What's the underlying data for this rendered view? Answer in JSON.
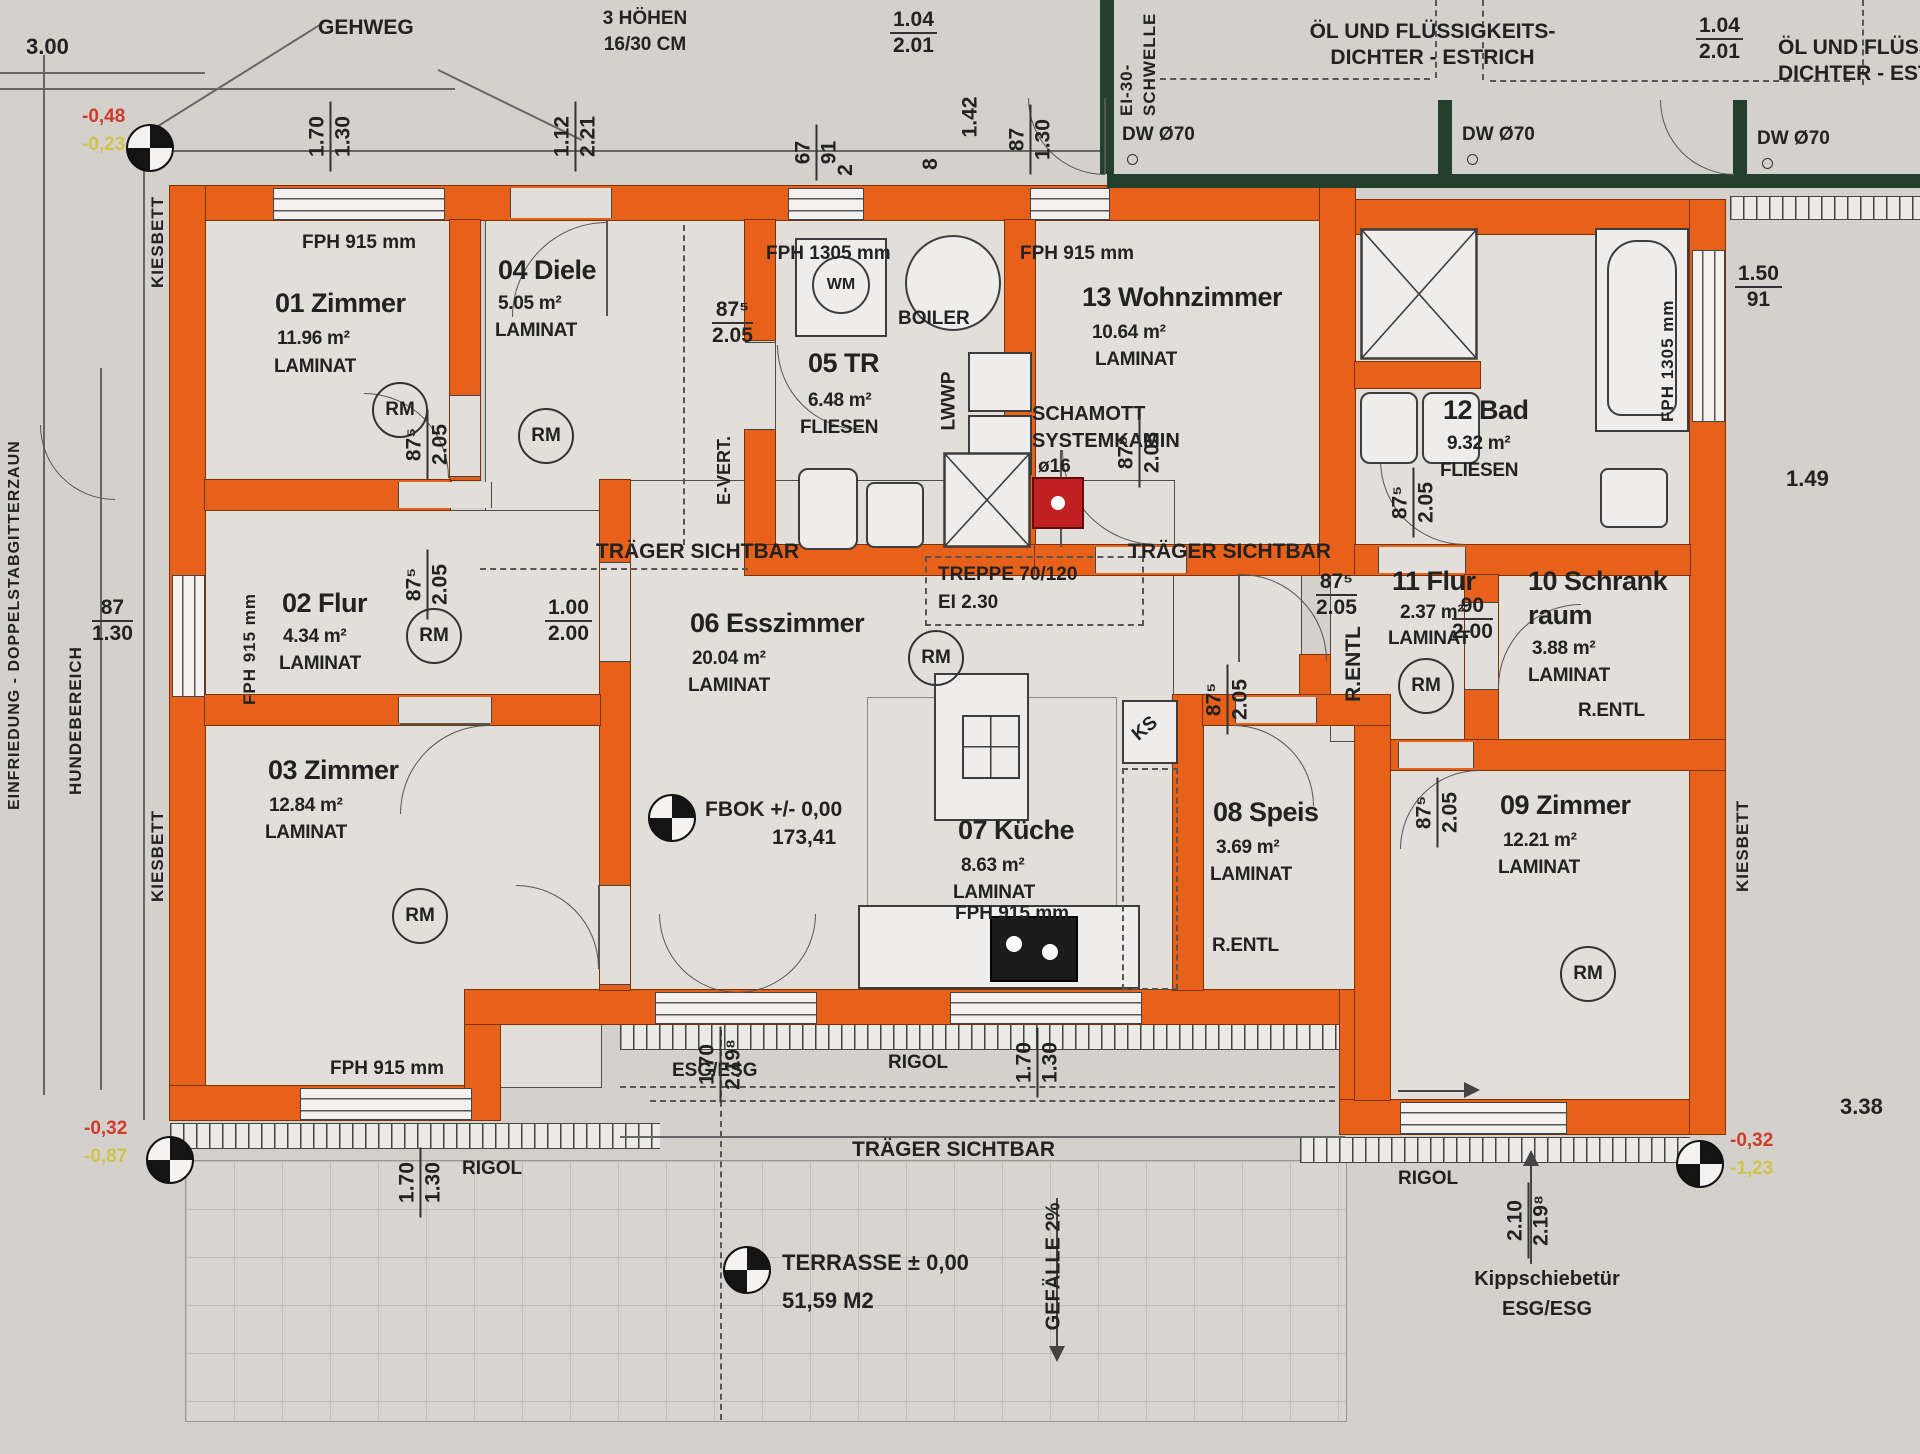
{
  "rooms": [
    {
      "title": "01 Zimmer",
      "area": "11.96 m²",
      "floor": "LAMINAT"
    },
    {
      "title": "02 Flur",
      "area": "4.34 m²",
      "floor": "LAMINAT"
    },
    {
      "title": "03 Zimmer",
      "area": "12.84 m²",
      "floor": "LAMINAT"
    },
    {
      "title": "04 Diele",
      "area": "5.05 m²",
      "floor": "LAMINAT"
    },
    {
      "title": "05 TR",
      "area": "6.48 m²",
      "floor": "FLIESEN"
    },
    {
      "title": "06 Esszimmer",
      "area": "20.04 m²",
      "floor": "LAMINAT"
    },
    {
      "title": "07 Küche",
      "area": "8.63 m²",
      "floor": "LAMINAT"
    },
    {
      "title": "08 Speis",
      "area": "3.69 m²",
      "floor": "LAMINAT"
    },
    {
      "title": "09 Zimmer",
      "area": "12.21 m²",
      "floor": "LAMINAT"
    },
    {
      "title": "10 Schrank",
      "title2": "raum",
      "area": "3.88 m²",
      "floor": "LAMINAT"
    },
    {
      "title": "11 Flur",
      "area": "2.37 m²",
      "floor": "LAMINAT"
    },
    {
      "title": "12 Bad",
      "area": "9.32 m²",
      "floor": "FLIESEN"
    },
    {
      "title": "13 Wohnzimmer",
      "area": "10.64 m²",
      "floor": "LAMINAT"
    }
  ],
  "labels": {
    "gehweg": "GEHWEG",
    "hoehen": "3 HÖHEN",
    "hoehen2": "16/30 CM",
    "oel1": "ÖL UND FLÜSSIGKEITS-",
    "oel2": "DICHTER - ESTRICH",
    "ei30a": "EI-30-",
    "ei30b": "SCHWELLE",
    "dw": "DW Ø70",
    "traeger": "TRÄGER SICHTBAR",
    "treppe": "TREPPE 70/120",
    "treppe2": "EI 2.30",
    "schamott": "SCHAMOTT",
    "schamott2": "SYSTEMKAMIN",
    "o16": "ø16",
    "boiler": "BOILER",
    "wm": "WM",
    "lwwp": "LWWP",
    "evert": "E-VERT.",
    "ks": "KS",
    "fph915": "FPH 915 mm",
    "fph1305": "FPH 1305 mm",
    "rentl": "R.ENTL",
    "fbok": "FBOK +/- 0,00",
    "fbok2": "173,41",
    "terrasse": "TERRASSE ± 0,00",
    "terrasse2": "51,59 M2",
    "gefaelle": "GEFÄLLE 2%",
    "rigol": "RIGOL",
    "esg": "ESG/ESG",
    "kipp": "Kippschiebetür",
    "kiesbett": "KIESBETT",
    "hunde": "HUNDEBEREICH",
    "zaun": "EINFRIEDUNG - DOPPELSTABGITTERZAUN",
    "rm": "RM"
  },
  "dims": {
    "d300": "3.00",
    "d170": "1.70",
    "d130": "1.30",
    "d112": "1.12",
    "d221": "2.21",
    "d67": "67",
    "d91": "91",
    "d2": "2",
    "d8": "8",
    "d142": "1.42",
    "d87": "87",
    "d875": "87⁵",
    "d205": "2.05",
    "d104": "1.04",
    "d201": "2.01",
    "d150": "1.50",
    "d149": "1.49",
    "d100": "1.00",
    "d200": "2.00",
    "d90": "90",
    "d2198": "2.19⁸",
    "d210": "2.10",
    "d338": "3.38"
  },
  "levels": {
    "tl1": "-0,48",
    "tl2": "-0,23",
    "bl1": "-0,32",
    "bl2": "-0,87",
    "br1": "-0,32",
    "br2": "-1,23"
  },
  "colors": {
    "wall": "#e8611a",
    "darkwall": "#24402c",
    "chimney": "#c12020"
  }
}
